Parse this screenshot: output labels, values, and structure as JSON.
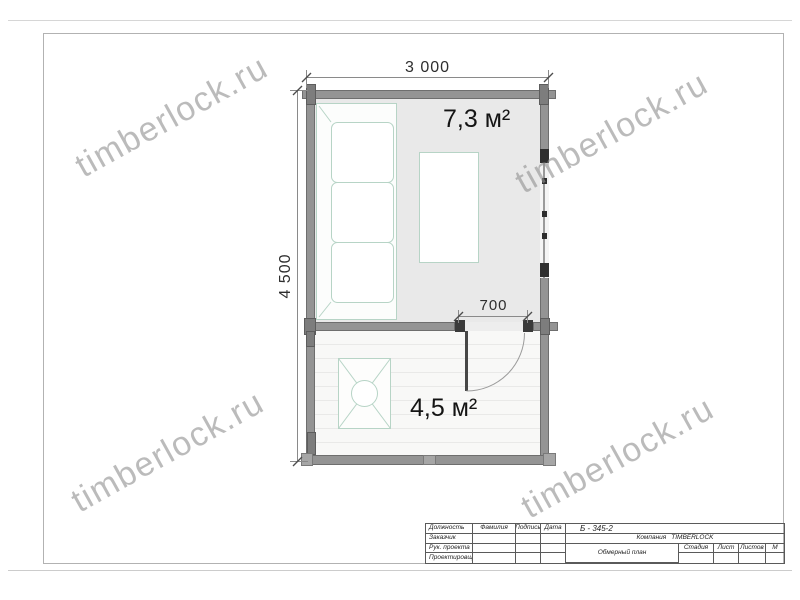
{
  "watermark": {
    "text": "timberlock.ru"
  },
  "plan": {
    "room_main_area": "7,3 м²",
    "room_terrace_area": "4,5 м²",
    "dim_width": "3 000",
    "dim_height": "4 500",
    "dim_door": "700"
  },
  "title_block": {
    "doc_number": "Б - 345-2",
    "company_label": "Компания",
    "company_name": "TIMBERLOCK",
    "drawing_title": "Обмерный план",
    "row_labels": [
      "Должность",
      "Заказчик",
      "Рук. проекта",
      "Проектировщик"
    ],
    "col_labels": [
      "Фамилия",
      "Подпись",
      "Дата"
    ],
    "stage_label": "Стадия",
    "sheet_label": "Лист",
    "sheets_label": "Листов",
    "scale_label": "М"
  }
}
